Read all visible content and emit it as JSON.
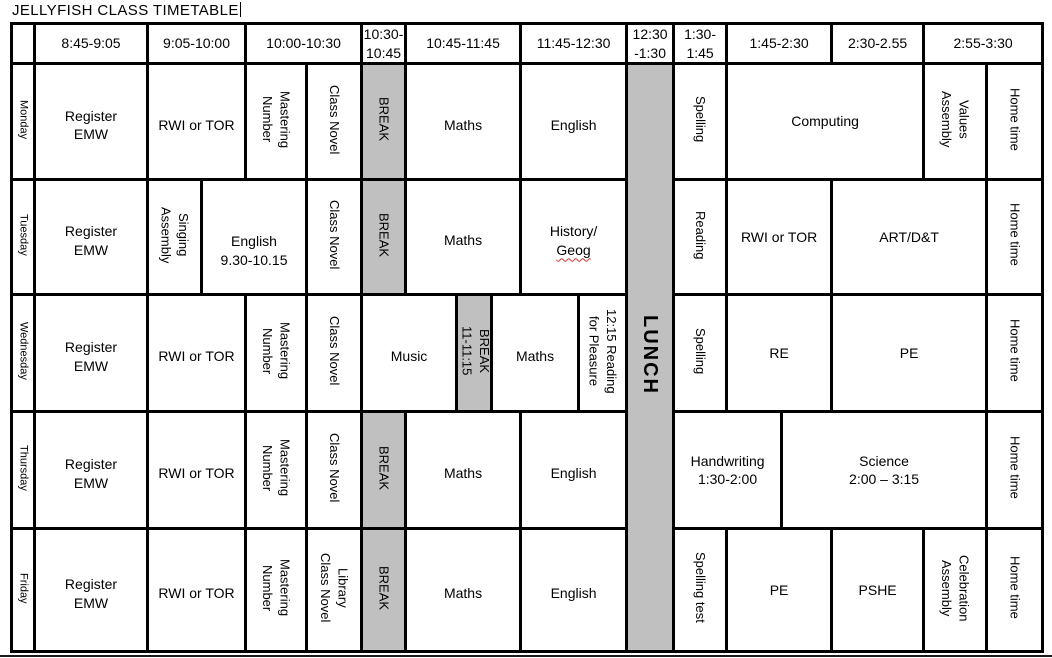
{
  "title": "JELLYFISH CLASS TIMETABLE",
  "colors": {
    "grid": "#000000",
    "break_fill": "#c0c0c0",
    "squiggle_red": "#cc3333"
  },
  "header": {
    "slots": [
      "8:45-9:05",
      "9:05-10:00",
      "10:00-10:30",
      "10:30-\n10:45",
      "10:45-11:45",
      "11:45-12:30",
      "12:30\n-1:30",
      "1:30-\n1:45",
      "1:45-2:30",
      "2:30-2.55",
      "2:55-3:30"
    ]
  },
  "lunch": "LUNCH",
  "rows": {
    "monday": {
      "day": "Monday",
      "register": "Register\nEMW",
      "rwi": "RWI or TOR",
      "mastering": "Mastering\nNumber",
      "class_novel": "Class Novel",
      "brk": "BREAK",
      "maths": "Maths",
      "english": "English",
      "spelling": "Spelling",
      "computing": "Computing",
      "values_assembly": "Values\nAssembly",
      "home": "Home time"
    },
    "tuesday": {
      "day": "Tuesday",
      "register": "Register\nEMW",
      "singing_assembly": "Singing\nAssembly",
      "english_early": "English\n9.30-10.15",
      "class_novel": "Class Novel",
      "brk": "BREAK",
      "maths": "Maths",
      "history_line1": "History/",
      "history_line2": "Geog",
      "reading": "Reading",
      "rwi": "RWI or TOR",
      "art": "ART/D&T",
      "home": "Home time"
    },
    "wednesday": {
      "day": "Wednesday",
      "register": "Register\nEMW",
      "rwi": "RWI or TOR",
      "mastering": "Mastering\nNumber",
      "class_novel": "Class Novel",
      "music": "Music",
      "brk": "BREAK\n11-11:15",
      "maths": "Maths",
      "reading_pleasure": "12:15 Reading\nfor Pleasure",
      "spelling": "Spelling",
      "re": "RE",
      "pe": "PE",
      "home": "Home time"
    },
    "thursday": {
      "day": "Thursday",
      "register": "Register\nEMW",
      "rwi": "RWI or TOR",
      "mastering": "Mastering\nNumber",
      "class_novel": "Class Novel",
      "brk": "BREAK",
      "maths": "Maths",
      "english": "English",
      "handwriting": "Handwriting\n1:30-2:00",
      "science": "Science\n2:00 – 3:15",
      "home": "Home time"
    },
    "friday": {
      "day": "Friday",
      "register": "Register\nEMW",
      "rwi": "RWI or TOR",
      "mastering": "Mastering\nNumber",
      "library_novel": "Library\nClass Novel",
      "brk": "BREAK",
      "maths": "Maths",
      "english": "English",
      "spelling_test": "Spelling test",
      "pe": "PE",
      "pshe": "PSHE",
      "celebration": "Celebration\nAssembly",
      "home": "Home time"
    }
  }
}
